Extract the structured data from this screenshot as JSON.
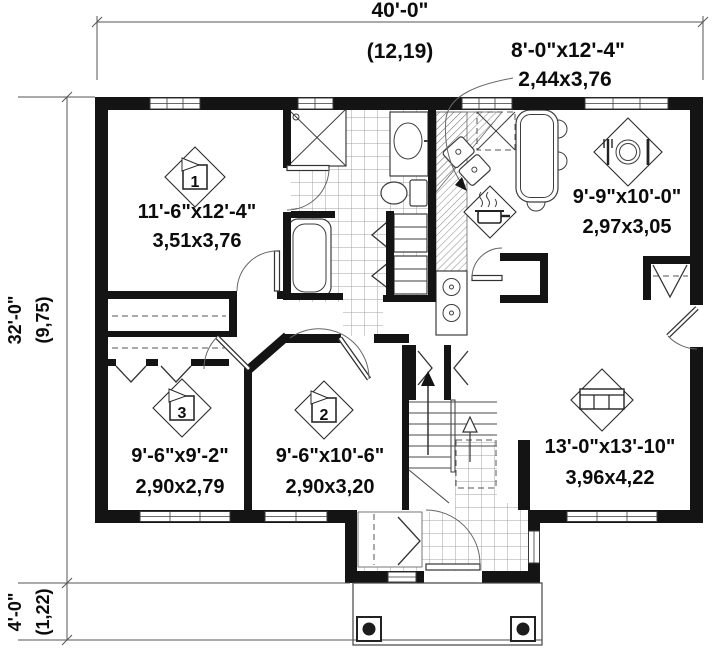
{
  "floorplan": {
    "dimensions": {
      "width_imperial": "40'-0\"",
      "width_metric": "(12,19)",
      "height_imperial": "32'-0\"",
      "height_metric": "(9,75)",
      "porch_imperial": "4'-0\"",
      "porch_metric": "(1,22)"
    },
    "rooms": {
      "kitchen": {
        "size_imperial": "8'-0\"x12'-4\"",
        "size_metric": "2,44x3,76",
        "icon": "pot-icon"
      },
      "bedroom1": {
        "marker": "1",
        "size_imperial": "11'-6\"x12'-4\"",
        "size_metric": "3,51x3,76"
      },
      "dining": {
        "icon": "dining-icon",
        "size_imperial": "9'-9\"x10'-0\"",
        "size_metric": "2,97x3,05"
      },
      "bedroom3": {
        "marker": "3",
        "size_imperial": "9'-6\"x9'-2\"",
        "size_metric": "2,90x2,79"
      },
      "bedroom2": {
        "marker": "2",
        "size_imperial": "9'-6\"x10'-6\"",
        "size_metric": "2,90x3,20"
      },
      "living": {
        "icon": "sofa-icon",
        "size_imperial": "13'-0\"x13'-10\"",
        "size_metric": "3,96x4,22"
      }
    },
    "stairs": {
      "icon": "up-arrow"
    },
    "colors": {
      "wall": "#141414",
      "line": "#4a4a4a",
      "tile_line": "#a0a0a0",
      "text": "#0c0c0c",
      "background": "#ffffff"
    }
  }
}
